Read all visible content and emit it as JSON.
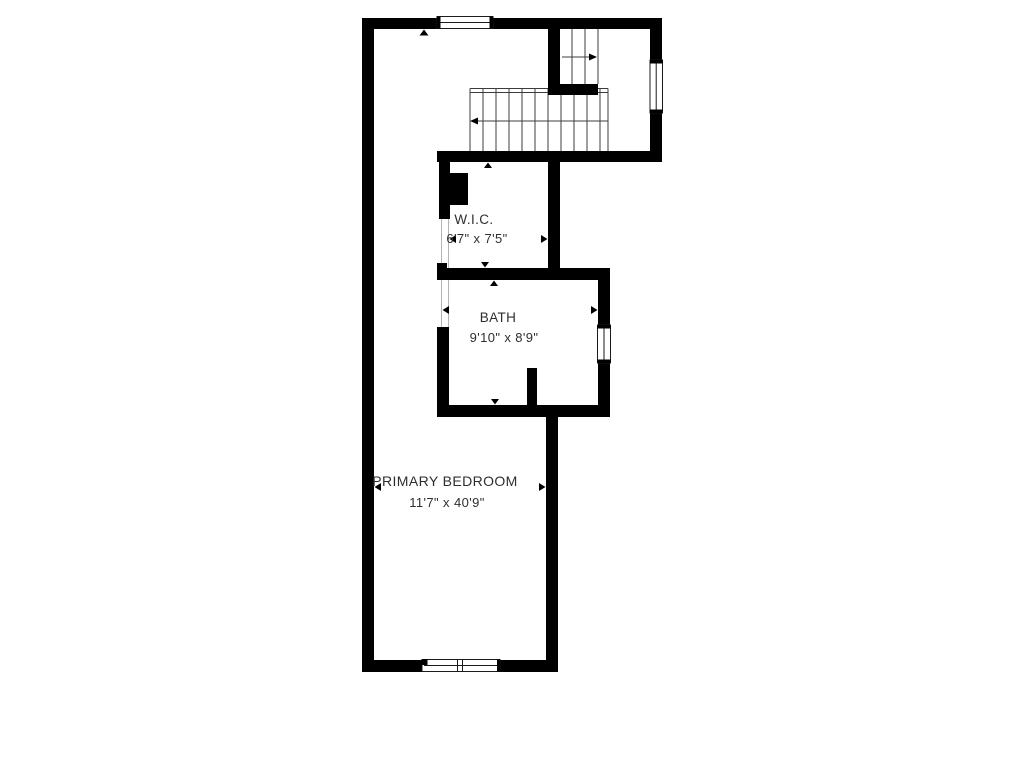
{
  "page": {
    "title": "Floor Plan"
  },
  "colors": {
    "wall": "#000000",
    "background": "#ffffff",
    "text": "#2e2e2e",
    "stair_line": "#3c3c3c",
    "opening_line": "#b4b4b4"
  },
  "rooms": [
    {
      "id": "wic",
      "name": "W.I.C.",
      "dimensions": "6'7\" x 7'5\""
    },
    {
      "id": "bath",
      "name": "BATH",
      "dimensions": "9'10\" x 8'9\""
    },
    {
      "id": "primary-bedroom",
      "name": "PRIMARY BEDROOM",
      "dimensions": "11'7\" x 40'9\""
    }
  ],
  "features": {
    "stairs": {
      "upper_flight_arrow": "right",
      "lower_flight_arrow": "left",
      "lower_flight_treads": 11,
      "upper_flight_treads": 3
    },
    "windows": [
      "top-wall-window",
      "upper-right-wall-window",
      "bath-right-wall-window",
      "bottom-wall-double-window"
    ],
    "other": [
      "wic-chimney-block",
      "bath-partition-stub",
      "wic-door-opening",
      "bath-door-opening"
    ]
  }
}
